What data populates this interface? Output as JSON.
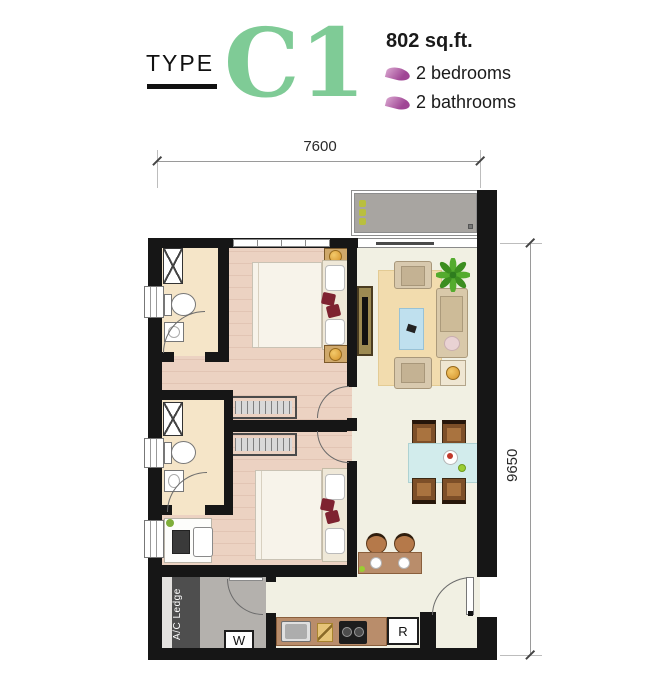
{
  "header": {
    "type_label": "TYPE",
    "unit_code": "C1",
    "area": "802 sq.ft.",
    "features": [
      {
        "icon": "leaf-icon",
        "label": "2 bedrooms"
      },
      {
        "icon": "leaf-icon",
        "label": "2 bathrooms"
      }
    ]
  },
  "dimensions": {
    "width_label": "7600",
    "height_label": "9650"
  },
  "plan_labels": {
    "ac_ledge": "A/C Ledge",
    "washer": "W",
    "fridge": "R"
  },
  "colors": {
    "accent_green": "#7fcb96",
    "leaf_purple": "#a04695",
    "wall_black": "#161616",
    "wood_floor": "#ecd2c2",
    "bath_floor": "#f5e5c8",
    "living_floor": "#f1f0e3",
    "balcony_gray": "#a8a5a1",
    "yard_gray": "#b4b1ad",
    "ledge_gray": "#4e4e4e",
    "counter_brown": "#b98d6b",
    "table_blue": "#d2ecec",
    "rug_beige": "#f2dcae",
    "pillow_red": "#7e2230",
    "lamp_gold": "#d4922a"
  }
}
